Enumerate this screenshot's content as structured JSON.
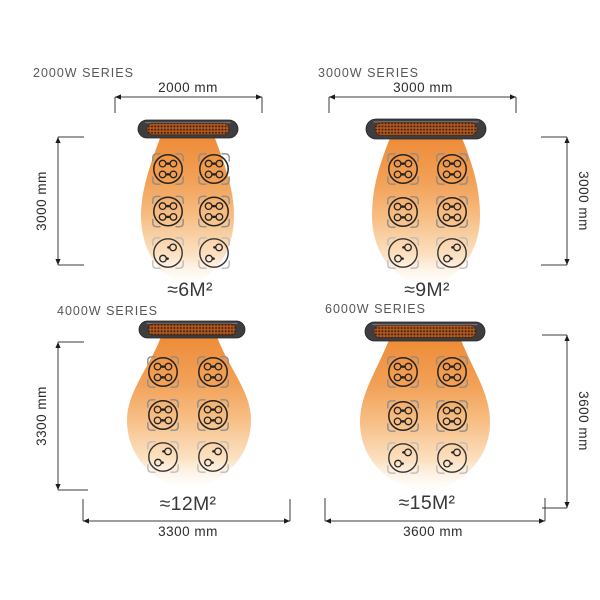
{
  "diagram": {
    "description": "Infrared patio heater coverage diagram, four wattage series with mounting dimensions and heated area",
    "colors": {
      "background": "#ffffff",
      "cone_top": "#ee8c38",
      "cone_mid": "#f6b97e",
      "cone_fade": "#fdeedd",
      "heater_body": "#3e3d3f",
      "heater_grill": "#aa5520",
      "dimension_line": "#3b3b3b",
      "title_text": "#56575a",
      "area_text": "#383838"
    },
    "icons": {
      "heater": "heater-bar-icon",
      "heat_spread": "heat-cone-icon",
      "seating": "dining-table-icon"
    },
    "panels": [
      {
        "id": "2000w-series",
        "title": "2000W SERIES",
        "width_label": "2000 mm",
        "height_label": "3000 mm",
        "area_label": "≈6M²"
      },
      {
        "id": "3000w-series",
        "title": "3000W SERIES",
        "width_label": "3000 mm",
        "height_label": "3000 mm",
        "area_label": "≈9M²"
      },
      {
        "id": "4000w-series",
        "title": "4000W SERIES",
        "width_label": "3300 mm",
        "height_label": "3300 mm",
        "area_label": "≈12M²"
      },
      {
        "id": "6000w-series",
        "title": "6000W SERIES",
        "width_label": "3600 mm",
        "height_label": "3600 mm",
        "area_label": "≈15M²"
      }
    ]
  }
}
